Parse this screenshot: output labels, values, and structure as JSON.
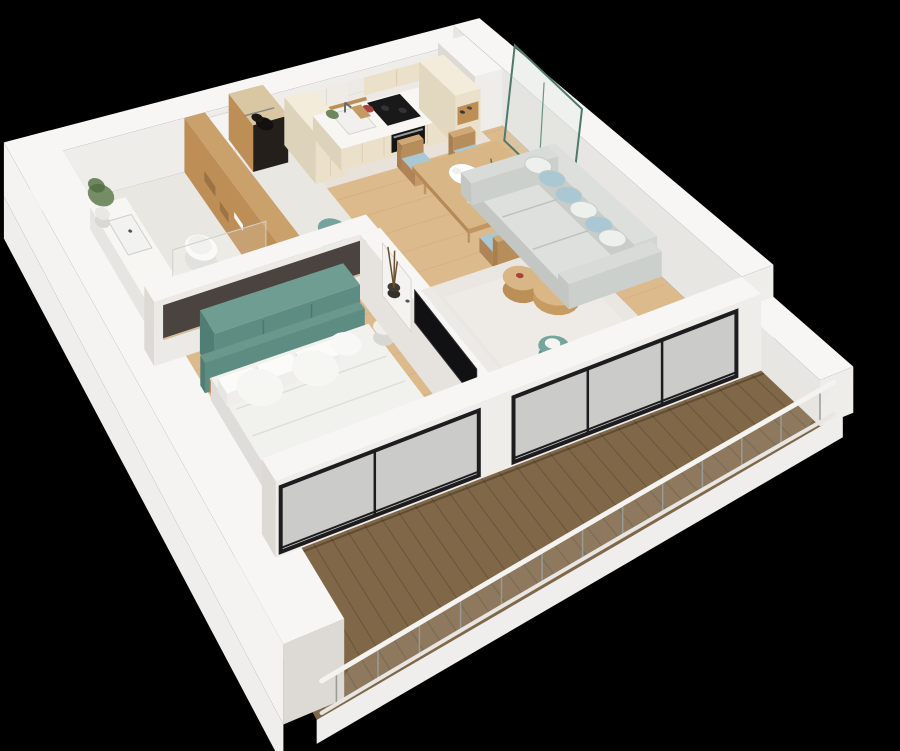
{
  "meta": {
    "type": "3d-floorplan-render",
    "style": "isometric dollhouse cutaway",
    "background": "black",
    "alt_text": "3D cutaway render of a one-bedroom apartment: bathroom, entry hall, kitchen, dining area, living room, bedroom and a long wood-deck balcony with glass railing"
  },
  "palette": {
    "background": "#000000",
    "wall_top": "#f7f6f4",
    "wall_face": "#efedea",
    "wall_face_med": "#e8e6e2",
    "wall_face_shadow": "#ddd9d4",
    "wall_exterior": "#f4f3f1",
    "floor_wood": "#dcba8c",
    "floor_wood_line": "#b08a55",
    "floor_tile": "#e9e7e2",
    "floor_shower": "#dedcd6",
    "deck_wood": "#806747",
    "deck_line": "#5c4a32",
    "accent_teal": "#5d8c82",
    "accent_teal_top": "#6f9d92",
    "accent_teal_dark": "#507d74",
    "pouf_teal": "#74a49b",
    "wood_warm": "#bd8f57",
    "wood_light": "#d9b685",
    "wood_mid": "#c89e6b",
    "cabinet_cream": "#ebe0c9",
    "cabinet_cream_top": "#f3ecda",
    "counter_white": "#f7f6f3",
    "marble": "#edeae6",
    "appliance_black": "#191919",
    "sofa_grey": "#d3d6d2",
    "sofa_grey_light": "#dde0dc",
    "pillow_white": "#eef0ee",
    "pillow_blue": "#a9c8d3",
    "rug_white": "#eae9e5",
    "bed_white": "#f1f1ee",
    "curtain_light": "#f3f2f0",
    "curtain_shadow": "#dbdad6",
    "glass_green_frame": "#4d7a6a",
    "glass_tint": "rgba(215,228,222,0.25)",
    "window_frame": "#1d1d1f",
    "glass_dark": "rgba(20,24,28,0.16)",
    "accent_dark_wall": "#4b4340",
    "plant_green": "#5f7d4f",
    "metal_grey": "#9a9a94"
  },
  "scene": {
    "rooms": [
      {
        "name": "bathroom",
        "items": [
          "vanity-with-sink",
          "wall-hung-toilet",
          "wooden-accent-wall",
          "potted-plant",
          "walk-in-shower"
        ]
      },
      {
        "name": "entry-hall",
        "items": [
          "entry-door",
          "open-wardrobe-niche",
          "teal-pouf"
        ]
      },
      {
        "name": "kitchen",
        "items": [
          "tall-cabinet",
          "base-cabinet-run",
          "marble-backsplash",
          "upper-cabinets",
          "wood-shelf",
          "cooktop",
          "built-in-oven",
          "sink-with-faucet"
        ]
      },
      {
        "name": "dining-area",
        "items": [
          "wooden-dining-table",
          "four-chairs-with-blue-cushions",
          "serving-tray",
          "houseplant"
        ]
      },
      {
        "name": "living-room",
        "items": [
          "grey-sofa",
          "scatter-pillows",
          "white-shag-rug",
          "round-nesting-coffee-tables",
          "wall-mounted-tv",
          "teal-pouf",
          "glass-partition-green-frame",
          "sheer-curtains"
        ]
      },
      {
        "name": "bedroom",
        "items": [
          "double-bed-white-linen",
          "teal-headboard",
          "teal-wardrobe",
          "dark-accent-wall",
          "foot-bench",
          "potted-plant",
          "sheer-curtains"
        ]
      },
      {
        "name": "balcony",
        "items": [
          "dark-wood-decking",
          "glass-railing",
          "white-handrail"
        ]
      }
    ]
  }
}
